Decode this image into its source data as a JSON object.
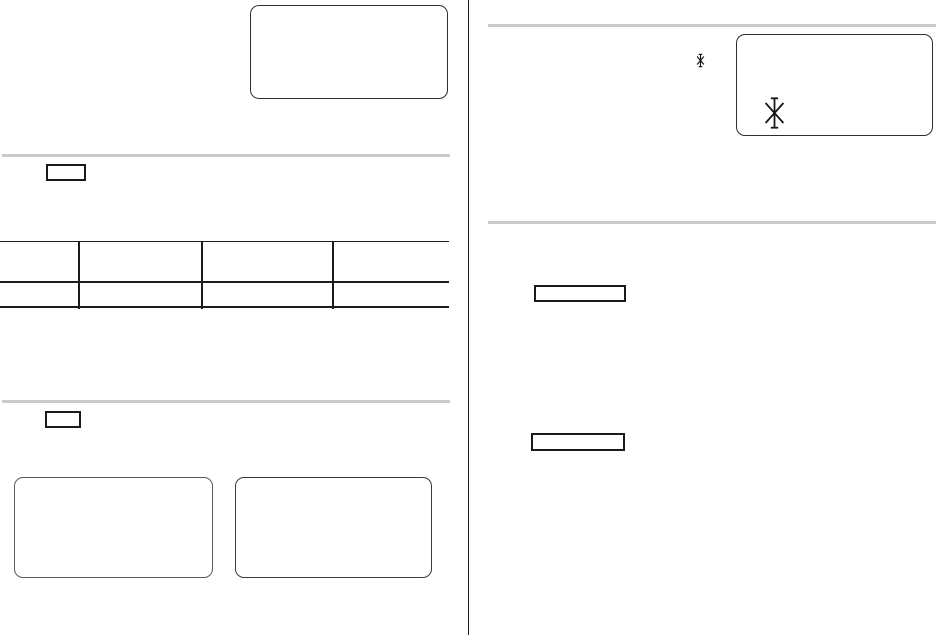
{
  "page": {
    "background_color": "#ffffff",
    "rule_color": "#1a1a1a",
    "divider_color": "#cacaca",
    "layout": "two-column printed document page, no visible text content"
  },
  "left_column": {
    "top_callout_box": {
      "content": ""
    },
    "section_1": {
      "heading_label_box": {
        "content": ""
      },
      "table": {
        "columns": 4,
        "rows": 2,
        "cells": [
          [
            "",
            "",
            "",
            ""
          ],
          [
            "",
            "",
            "",
            ""
          ]
        ]
      }
    },
    "section_2": {
      "heading_label_box": {
        "content": ""
      },
      "callout_box_1": {
        "content": ""
      },
      "callout_box_2": {
        "content": ""
      }
    }
  },
  "right_column": {
    "section_1": {
      "footnote_marker_icon": "asterisk",
      "callout_box": {
        "content": "",
        "marker_icon": "asterisk"
      }
    },
    "section_2": {
      "label_box_1": {
        "content": ""
      },
      "label_box_2": {
        "content": ""
      }
    }
  },
  "icons": {
    "asterisk_small": "✱",
    "asterisk_large": "✱"
  }
}
